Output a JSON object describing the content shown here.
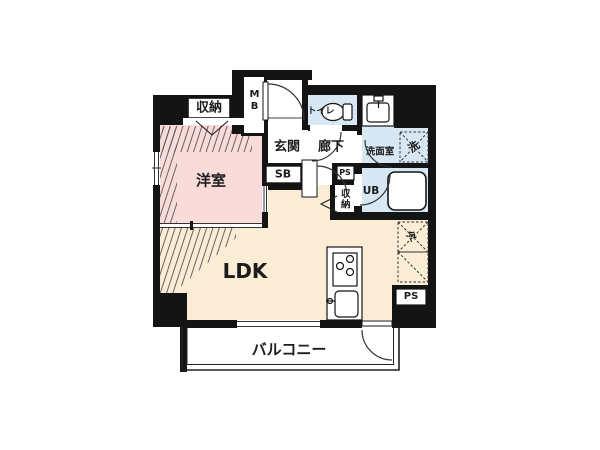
{
  "plan_title": "1LDK floor plan",
  "colors": {
    "wall": "#141414",
    "western_room_fill": "#f9dcd9",
    "ldk_fill": "#faecd5",
    "wet_area_fill": "#d7e8f4",
    "line": "#2a2a2a"
  },
  "rooms": {
    "western_room": {
      "label": "洋室"
    },
    "ldk": {
      "label": "LDK"
    },
    "balcony": {
      "label": "バルコニー"
    },
    "entrance": {
      "label": "玄関"
    },
    "hallway": {
      "label": "廊下"
    },
    "toilet": {
      "label": "トイレ"
    },
    "washroom": {
      "label": "洗面室"
    },
    "unit_bath": {
      "label": "UB"
    },
    "closet_top": {
      "label": "収納"
    },
    "closet_mid": {
      "label": "収納"
    },
    "washer_space": {
      "label": "洗"
    },
    "fridge_space": {
      "label": "冷"
    },
    "meter_box": {
      "label": "MB"
    },
    "shoe_box": {
      "label": "SB"
    },
    "pipe_space_upper": {
      "label": "PS"
    },
    "pipe_space_lower": {
      "label": "PS"
    }
  }
}
